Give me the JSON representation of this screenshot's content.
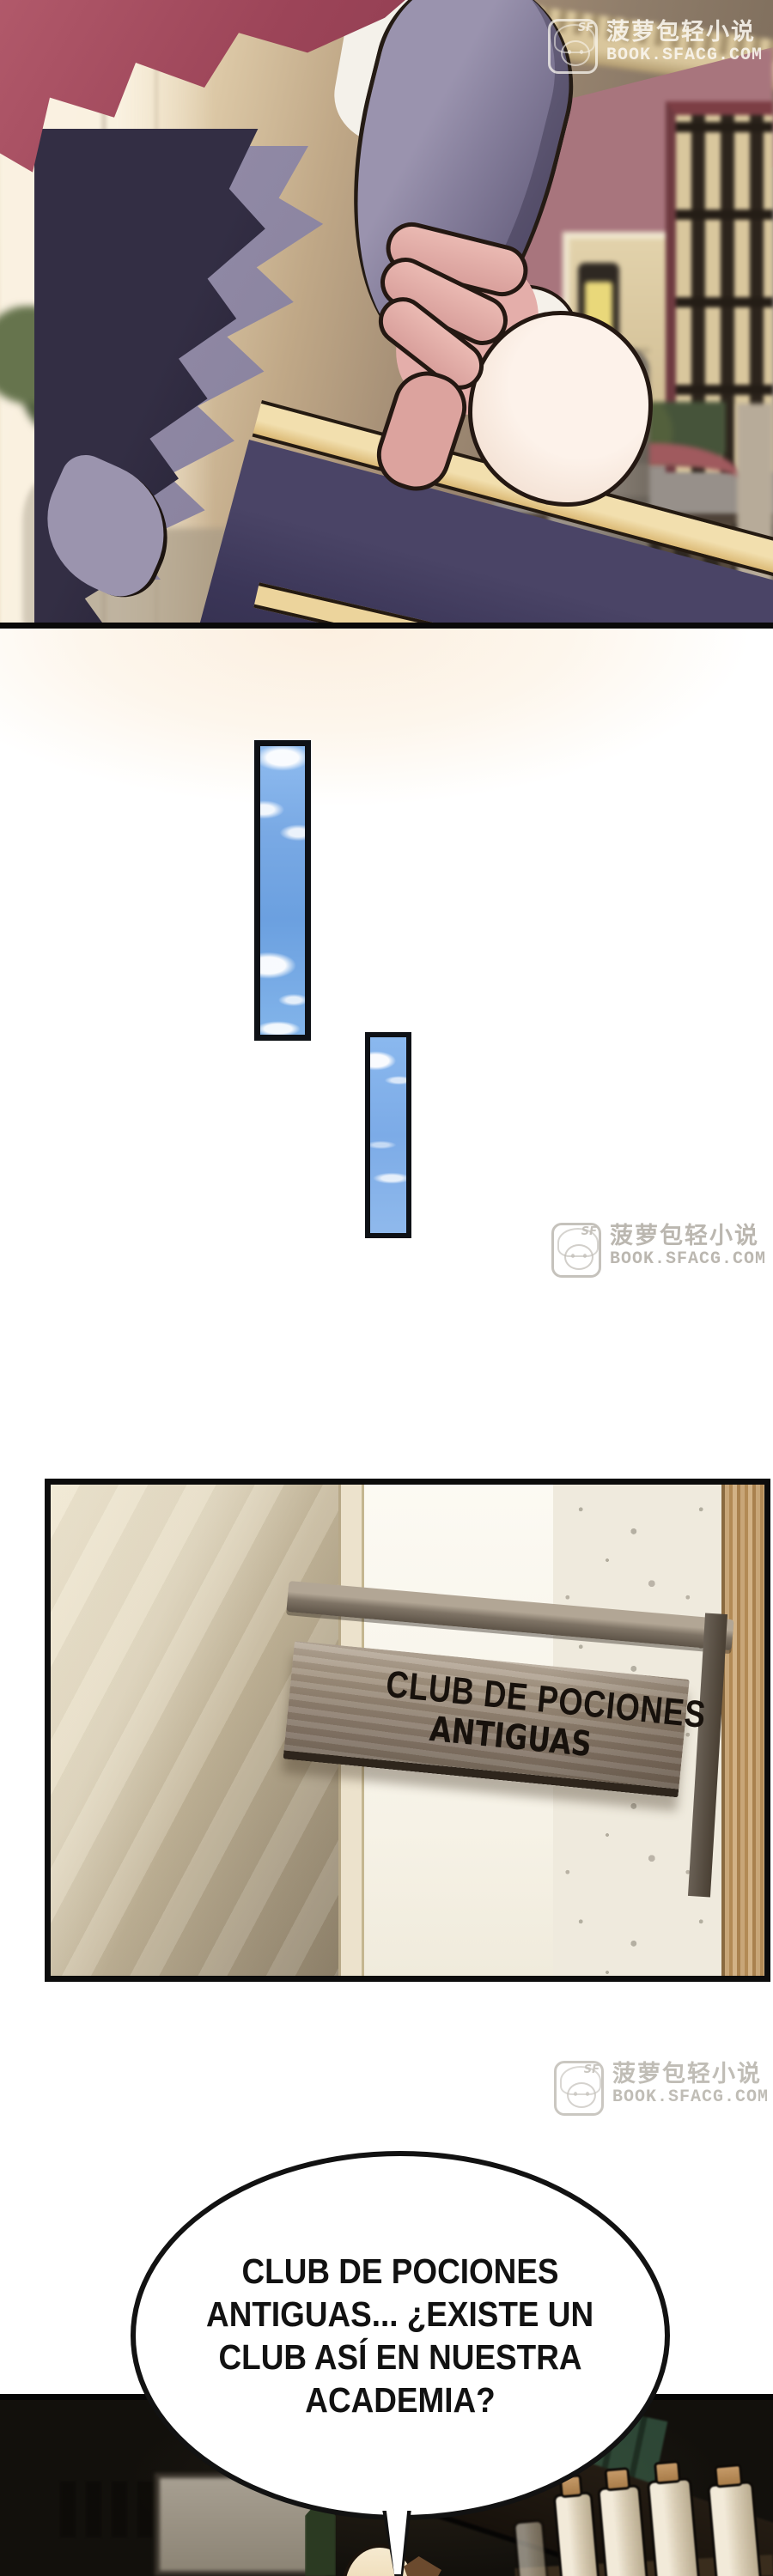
{
  "watermark": {
    "icon_label": "SF",
    "site_name": "菠萝包轻小说",
    "site_url": "BOOK.SFACG.COM"
  },
  "door_sign": {
    "line1": "CLUB DE POCIONES",
    "line2": "ANTIGUAS"
  },
  "speech_bubble": {
    "lines": [
      "CLUB DE POCIONES",
      "ANTIGUAS... ¿EXISTE UN",
      "CLUB ASÍ EN NUESTRA",
      "ACADEMIA?"
    ]
  },
  "palette": {
    "panel_border": "#0c0c0c",
    "bubble_outline": "#121212",
    "sky_blue": "#7fb3e8",
    "cape_red": "#9c4458",
    "gold_trim": "#d9b76a",
    "navy_sleeve": "#3b3658",
    "frill_grey": "#8e87a3",
    "wood_sign": "#8f8070",
    "watermark_grey": "#c6c2bc"
  }
}
